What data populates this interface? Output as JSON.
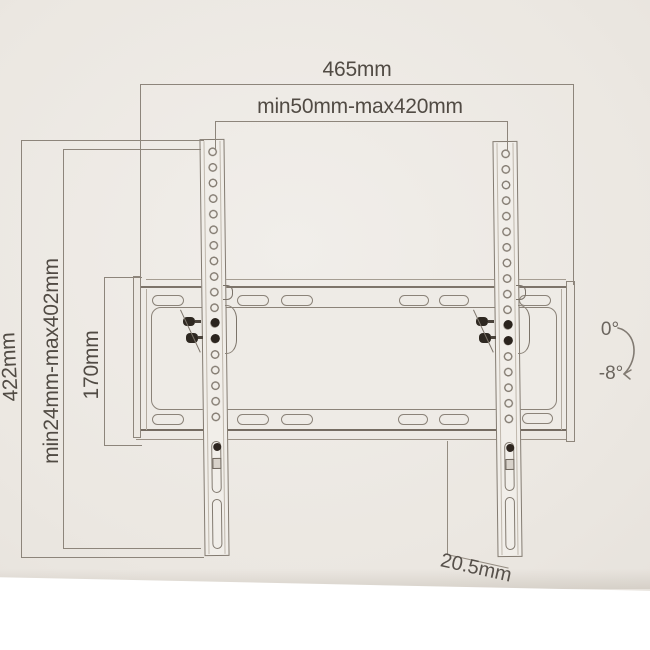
{
  "labels": {
    "total_width": "465mm",
    "rail_range": "min50mm-max420mm",
    "total_height": "422mm",
    "vesa_range": "min24mm-max402mm",
    "plate_height": "170mm",
    "depth": "20.5mm",
    "tilt_max": "0°",
    "tilt_min": "-8°"
  },
  "colors": {
    "paper": "#ebe7e1",
    "line": "#8d857b",
    "text": "#514b44",
    "hardware_dark": "#2b241e",
    "background": "#ffffff"
  }
}
